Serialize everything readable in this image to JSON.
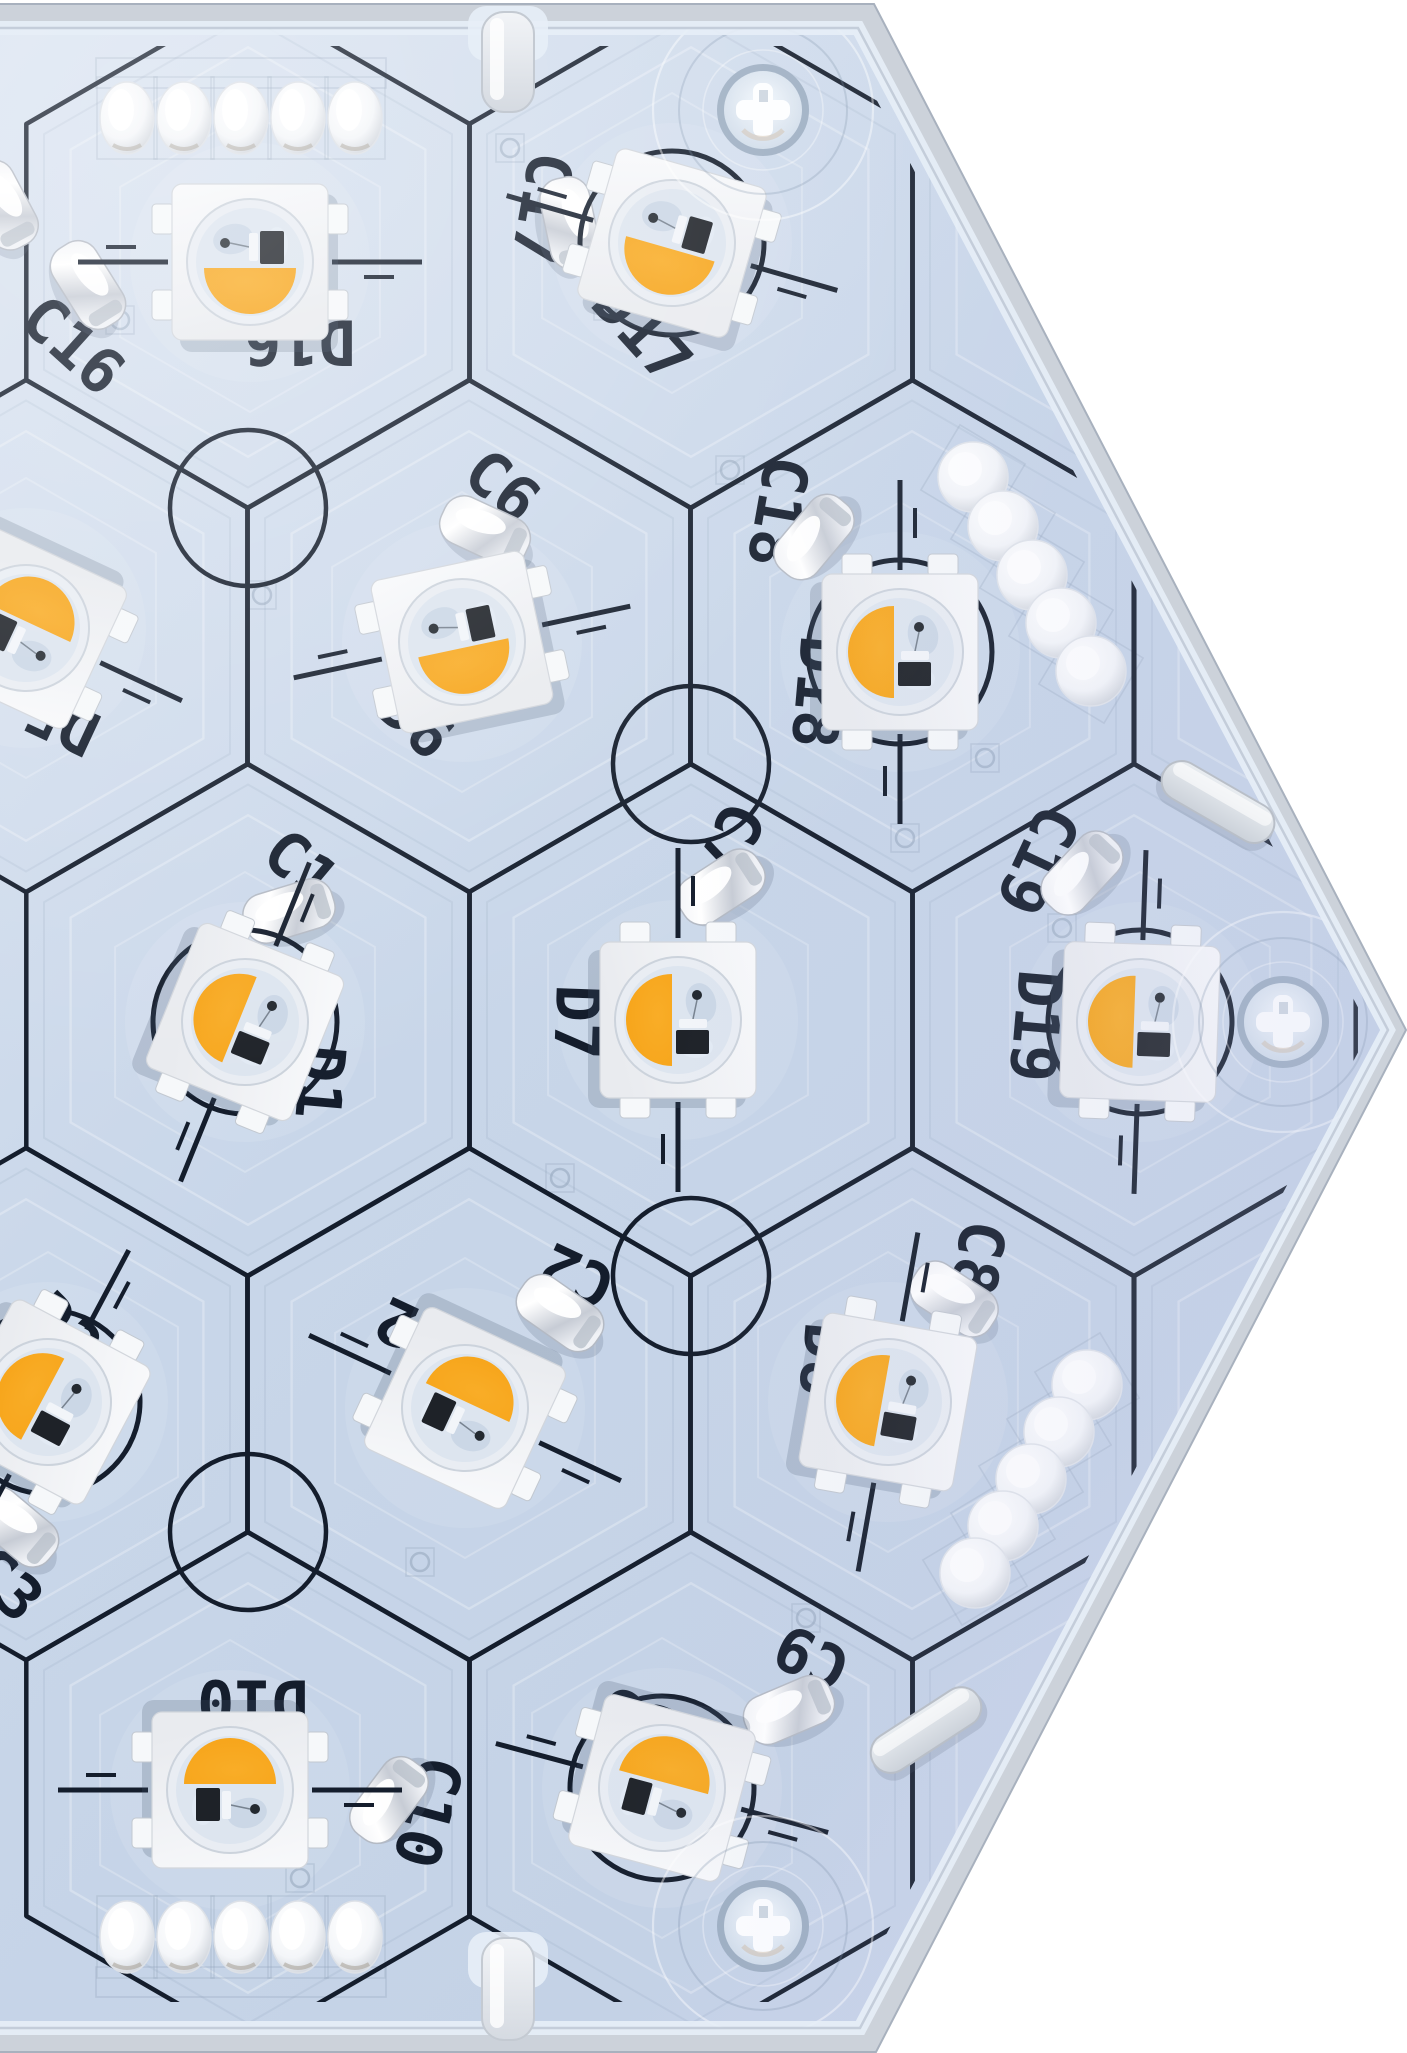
{
  "meta": {
    "subject": "Macro photo of a hexagonal addressable RGBW LED printed circuit board (top side) with honeycomb silkscreen grid, SMD LEDs, capacitors, edge solder pads, screw holes and mounting-tab notches"
  },
  "colors": {
    "bg": "#ffffff",
    "frame": "#ccd2da",
    "frame_line": "#a8b1be",
    "pcb_tl": "#dbe4f1",
    "pcb_mid": "#c8d6e9",
    "pcb_right": "#cbd4ec",
    "bevel": "#e7eef7",
    "bevel_dark": "#b7c1cf",
    "silk": "#141d2c",
    "etch_white": "rgba(255,255,255,0.5)",
    "etch_gray": "rgba(120,140,165,0.22)",
    "led_body_hi": "#f8f9fb",
    "led_body_lo": "#e9ebef",
    "led_lens": "#e9edf3",
    "led_inner": "#dde5ef",
    "phosphor": "#f6a318",
    "phosphor_hi": "#f9ad27",
    "chip": "#1e2228",
    "metal_hi": "#ffffff",
    "metal_lo": "#c7ccd5",
    "hole_rim": "#9daec2",
    "standoff": "#fdfeff"
  },
  "board": {
    "w": 1407,
    "h": 2053,
    "pcb_poly": "-40,28 858,28 1388,1030 860,2028 -40,2028",
    "frame_poly": "-40,4 874,4 1406,1030 876,2052 -40,2052",
    "grid_clip_poly": "-40,46 848,46 1370,1030 850,2002 -40,2002"
  },
  "grid": {
    "hex_radius": 256,
    "rows": [
      {
        "y": 252,
        "xs": [
          248,
          691,
          1134
        ]
      },
      {
        "y": 636,
        "xs": [
          26,
          469,
          912,
          1356
        ]
      },
      {
        "y": 1020,
        "xs": [
          248,
          691,
          1134
        ]
      },
      {
        "y": 1404,
        "xs": [
          26,
          469,
          912,
          1356
        ]
      },
      {
        "y": 1788,
        "xs": [
          248,
          691,
          1134
        ]
      }
    ],
    "junction_circles": [
      [
        248,
        508
      ],
      [
        691,
        764
      ],
      [
        691,
        1276
      ],
      [
        248,
        1532
      ]
    ],
    "junction_circle_r": 78,
    "line_width": 4.5
  },
  "leds": [
    {
      "id": "D16",
      "x": 250,
      "y": 262,
      "rot": 0,
      "ring": false
    },
    {
      "id": "D17",
      "x": 672,
      "y": 243,
      "rot": 16,
      "ring": true
    },
    {
      "id": "D5",
      "x": 26,
      "y": 628,
      "rot": 205,
      "ring": false
    },
    {
      "id": "D6",
      "x": 462,
      "y": 642,
      "rot": -12,
      "ring": false
    },
    {
      "id": "D18",
      "x": 900,
      "y": 652,
      "rot": 90,
      "ring": true
    },
    {
      "id": "D1",
      "x": 245,
      "y": 1022,
      "rot": 112,
      "ring": true
    },
    {
      "id": "D7",
      "x": 678,
      "y": 1020,
      "rot": 90,
      "ring": false
    },
    {
      "id": "D19",
      "x": 1140,
      "y": 1022,
      "rot": 92,
      "ring": true
    },
    {
      "id": "D3",
      "x": 48,
      "y": 1402,
      "rot": 118,
      "ring": true
    },
    {
      "id": "D2",
      "x": 465,
      "y": 1408,
      "rot": 205,
      "ring": false
    },
    {
      "id": "D8",
      "x": 888,
      "y": 1402,
      "rot": 100,
      "ring": false
    },
    {
      "id": "D10",
      "x": 230,
      "y": 1790,
      "rot": 180,
      "ring": false
    },
    {
      "id": "D9",
      "x": 662,
      "y": 1788,
      "rot": 195,
      "ring": true
    }
  ],
  "capacitors": [
    {
      "id": "C16",
      "x": 88,
      "y": 285,
      "rot": 58
    },
    {
      "id": "C17",
      "x": 570,
      "y": 223,
      "rot": 78
    },
    {
      "id": "C6",
      "x": 485,
      "y": 531,
      "rot": 25
    },
    {
      "id": "C18",
      "x": 814,
      "y": 537,
      "rot": -50
    },
    {
      "id": "C1",
      "x": 289,
      "y": 911,
      "rot": -17
    },
    {
      "id": "C7",
      "x": 721,
      "y": 887,
      "rot": -33
    },
    {
      "id": "C19",
      "x": 1082,
      "y": 873,
      "rot": -47
    },
    {
      "id": "C2",
      "x": 560,
      "y": 1313,
      "rot": 35
    },
    {
      "id": "C8",
      "x": 954,
      "y": 1299,
      "rot": 33
    },
    {
      "id": "C10",
      "x": 389,
      "y": 1800,
      "rot": -53
    },
    {
      "id": "C9",
      "x": 789,
      "y": 1710,
      "rot": -23
    },
    {
      "id": "C3",
      "x": 16,
      "y": 1527,
      "rot": 40
    },
    {
      "id": "",
      "x": 2,
      "y": 205,
      "rot": 62
    }
  ],
  "labels": [
    {
      "text": "C16",
      "x": 73,
      "y": 345,
      "rot": 42
    },
    {
      "text": "D16",
      "x": 300,
      "y": 342,
      "rot": 180
    },
    {
      "text": "C17",
      "x": 542,
      "y": 208,
      "rot": 100
    },
    {
      "text": "D17",
      "x": 642,
      "y": 332,
      "rot": 48
    },
    {
      "text": "C6",
      "x": 502,
      "y": 486,
      "rot": 40
    },
    {
      "text": "D6",
      "x": 416,
      "y": 722,
      "rot": 42
    },
    {
      "text": "C18",
      "x": 778,
      "y": 512,
      "rot": 100
    },
    {
      "text": "D18",
      "x": 818,
      "y": 692,
      "rot": 95
    },
    {
      "text": "C1",
      "x": 301,
      "y": 866,
      "rot": 40
    },
    {
      "text": "D1",
      "x": 320,
      "y": 1082,
      "rot": 95
    },
    {
      "text": "C7",
      "x": 731,
      "y": 840,
      "rot": 115
    },
    {
      "text": "D7",
      "x": 577,
      "y": 1022,
      "rot": 92
    },
    {
      "text": "C19",
      "x": 1038,
      "y": 860,
      "rot": 115
    },
    {
      "text": "D19",
      "x": 1036,
      "y": 1026,
      "rot": 95
    },
    {
      "text": "C2",
      "x": 577,
      "y": 1276,
      "rot": 205
    },
    {
      "text": "D2",
      "x": 413,
      "y": 1330,
      "rot": 205
    },
    {
      "text": "C8",
      "x": 978,
      "y": 1258,
      "rot": 100
    },
    {
      "text": "D8",
      "x": 824,
      "y": 1360,
      "rot": 95
    },
    {
      "text": "D5",
      "x": 62,
      "y": 722,
      "rot": 205
    },
    {
      "text": "D3",
      "x": 64,
      "y": 1330,
      "rot": 45
    },
    {
      "text": "C3",
      "x": 6,
      "y": 1584,
      "rot": 45
    },
    {
      "text": "D10",
      "x": 253,
      "y": 1702,
      "rot": 180
    },
    {
      "text": "C10",
      "x": 428,
      "y": 1812,
      "rot": 105
    },
    {
      "text": "D9",
      "x": 636,
      "y": 1718,
      "rot": 202
    },
    {
      "text": "C9",
      "x": 812,
      "y": 1658,
      "rot": 205
    }
  ],
  "pads": {
    "oval_rows": [
      {
        "y": 118,
        "xs": [
          127,
          184,
          241,
          298,
          355
        ]
      },
      {
        "y": 1937,
        "xs": [
          127,
          184,
          241,
          298,
          355
        ]
      }
    ],
    "oval_rx": 27,
    "oval_ry": 36,
    "round_top_diag": {
      "rot": 31,
      "pts": [
        [
          973,
          477
        ],
        [
          1003,
          526
        ],
        [
          1032,
          575
        ],
        [
          1061,
          623
        ],
        [
          1091,
          671
        ]
      ]
    },
    "round_bottom_diag": {
      "rot": -31,
      "pts": [
        [
          1087,
          1385
        ],
        [
          1059,
          1432
        ],
        [
          1031,
          1479
        ],
        [
          1003,
          1526
        ],
        [
          975,
          1573
        ]
      ]
    },
    "round_r": 35
  },
  "screw_holes": [
    [
      763,
      110
    ],
    [
      1283,
      1022
    ],
    [
      763,
      1926
    ]
  ],
  "edge_notch_posts": [
    {
      "x": 508,
      "y": 12,
      "h": 100
    },
    {
      "x": 508,
      "y": 1938,
      "h": 102
    }
  ],
  "edge_tabs": [
    {
      "x": 1218,
      "y": 802,
      "rot": 30
    },
    {
      "x": 926,
      "y": 1730,
      "rot": -33
    }
  ],
  "vias": [
    [
      120,
      320
    ],
    [
      262,
      595
    ],
    [
      510,
      148
    ],
    [
      730,
      470
    ],
    [
      905,
      838
    ],
    [
      560,
      1178
    ],
    [
      1062,
      928
    ],
    [
      420,
      1562
    ],
    [
      806,
      1618
    ],
    [
      300,
      1878
    ],
    [
      608,
      306
    ],
    [
      985,
      758
    ]
  ]
}
